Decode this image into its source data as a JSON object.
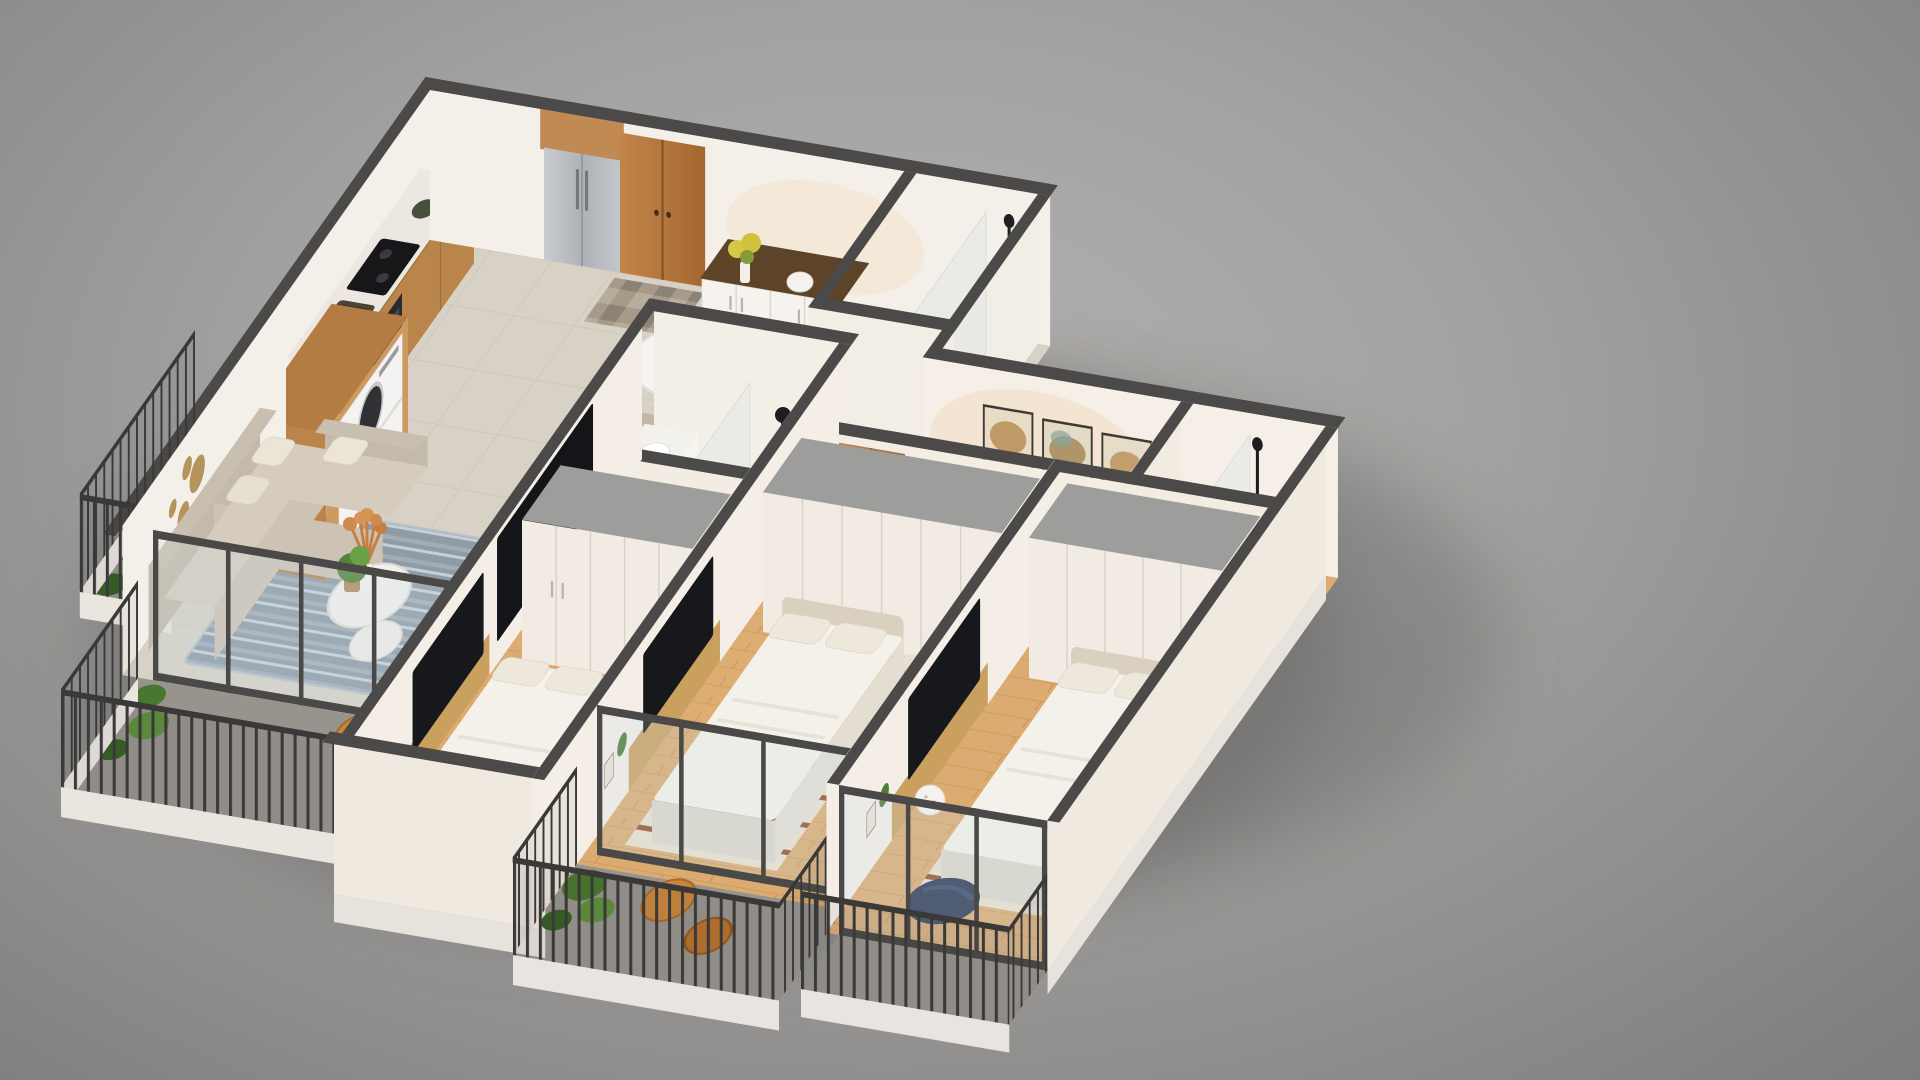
{
  "scene": {
    "title": "3D isometric apartment floor plan render",
    "description": "Cutaway 3D render of a three-bedroom apartment viewed from above on a gray studio background",
    "background": {
      "center": "#b3b1af",
      "edge": "#7d7c7b"
    },
    "palette": {
      "wall_cap": "#4b4a48",
      "wall_face": "#f4efe8",
      "wood_door": "#b5763a",
      "tile_floor": "#d8d1c5",
      "wood_floor": "#dcab72",
      "balcony_floor": "#97938d",
      "wardrobe": "#f1ebe3",
      "wardrobe_top": "#9d9d9b",
      "sofa": "#cdc3b5",
      "rug_living": "#8f9ba7",
      "bed_duvet": "#f4f1ea",
      "bed_rug": "#eadfce",
      "rail": "#3a3938",
      "steel": "#b9bcbe",
      "plant": "#4e7d38",
      "stool_wood": "#c8863e",
      "beanbag": "#2c3852",
      "gold_decor": "#b08c4f"
    },
    "rooms": [
      {
        "name": "kitchen",
        "items": [
          "counter-with-cooktop-and-sink",
          "fridge-with-wood-cabinet",
          "entry-double-door",
          "doormat"
        ]
      },
      {
        "name": "dining-area",
        "items": [
          "sideboard-with-flowers",
          "oval-dining-table",
          "six-chairs",
          "place-settings",
          "pink-centerpiece"
        ]
      },
      {
        "name": "wc",
        "items": [
          "toilet",
          "glass-shower",
          "black-shower-fixture"
        ]
      },
      {
        "name": "laundry-nook",
        "items": [
          "stacked-washer-dryer",
          "wood-cabinet",
          "wicker-basket"
        ]
      },
      {
        "name": "balcony-west",
        "items": [
          "green-plant-wall",
          "metal-railing"
        ]
      },
      {
        "name": "living-room",
        "items": [
          "l-shaped-sofa",
          "round-coffee-tables",
          "pampas-vase",
          "striped-rug",
          "gold-wall-circles",
          "tv-wall",
          "fiddle-leaf-plant",
          "glass-doors"
        ]
      },
      {
        "name": "balcony-south",
        "items": [
          "wood-stools",
          "plants",
          "metal-railing"
        ]
      },
      {
        "name": "hallway",
        "items": [
          "three-framed-artworks",
          "wood-doors",
          "checkered-mat"
        ]
      },
      {
        "name": "main-bathroom",
        "items": [
          "vanity-with-basin",
          "mirror",
          "toilet",
          "glass-shower",
          "black-shower-column",
          "wood-door-leaf"
        ]
      },
      {
        "name": "bedroom-1",
        "items": [
          "wardrobe",
          "double-bed",
          "striped-side-rug",
          "desk-with-tv",
          "bedside-lamp",
          "rattan-chair"
        ]
      },
      {
        "name": "bedroom-2",
        "items": [
          "wardrobe",
          "double-bed",
          "striped-side-rug",
          "desk-with-tv",
          "glass-doors"
        ]
      },
      {
        "name": "bedroom-3",
        "items": [
          "wardrobe",
          "double-bed",
          "striped-side-rug",
          "desk-with-tv",
          "navy-beanbag",
          "sphere-lamp",
          "glass-doors"
        ]
      },
      {
        "name": "balcony-bedrooms",
        "items": [
          "two-wood-stools",
          "plants",
          "metal-railing"
        ]
      },
      {
        "name": "ensuite-bathroom",
        "items": [
          "toilet",
          "glass-panel",
          "black-shower-fixture"
        ]
      }
    ]
  }
}
